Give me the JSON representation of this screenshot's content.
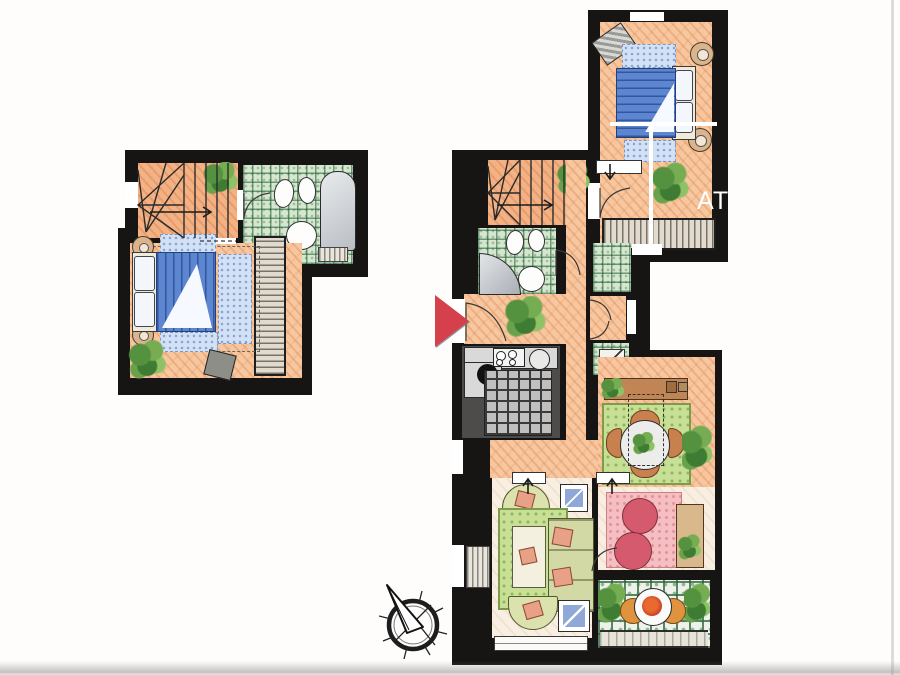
{
  "annotation": {
    "wall_label": "AT"
  },
  "palette": {
    "wall": "#171513",
    "floor_orange": "#f6c7a0",
    "floor_cream": "#f8efe2",
    "tile_green": "#d6e7d0",
    "kitchen_dark": "#4e4c4a",
    "bed_blue": "#5c86cf",
    "rug_blue": "#d3e1f4",
    "rug_green": "#c8df96",
    "rug_pink": "#f4bec2",
    "pouf_red": "#d65a6e",
    "chair_terracotta": "#c9804f",
    "entrance_marker_red": "#d5404d"
  },
  "icons": {
    "entrance_marker": "red-triangle-pointing-right",
    "compass": "compass-rose-needle-northwest"
  }
}
